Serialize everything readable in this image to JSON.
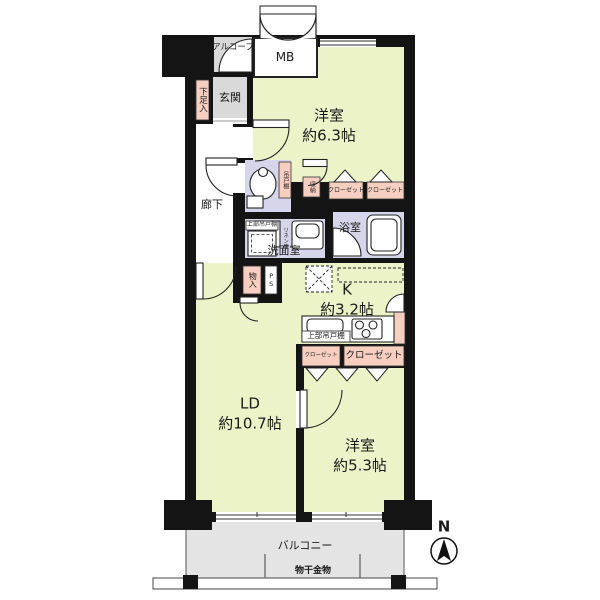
{
  "colors": {
    "wall": "#141414",
    "room_floor": "#edf3c8",
    "wet_floor": "#d6d6ea",
    "storage_floor": "#f6cfc0",
    "entry_floor": "#d9d9d9",
    "balcony_floor": "#e4e4e4"
  },
  "labels": {
    "alcove": "アルコーブ",
    "meter_box": "MB",
    "entrance": "玄関",
    "shoe_cabinet": "下足入",
    "bedroom1": {
      "name": "洋室",
      "size": "約6.3帖"
    },
    "hallway": "廊下",
    "toilet_cupboard": "吊戸棚",
    "storage": "収納",
    "closet": "クローゼット",
    "bath": "浴室",
    "washroom": "洗面室",
    "linen": "リネン庫",
    "upper_cabinet": "上部吊戸棚",
    "utility_closet": "物入",
    "pipe_space": "PS",
    "kitchen": {
      "name": "K",
      "size": "約3.2帖"
    },
    "living_dining": {
      "name": "LD",
      "size": "約10.7帖"
    },
    "bedroom2": {
      "name": "洋室",
      "size": "約5.3帖"
    },
    "balcony": "バルコニー",
    "laundry_hardware": "物干金物",
    "north_mark": "N"
  }
}
